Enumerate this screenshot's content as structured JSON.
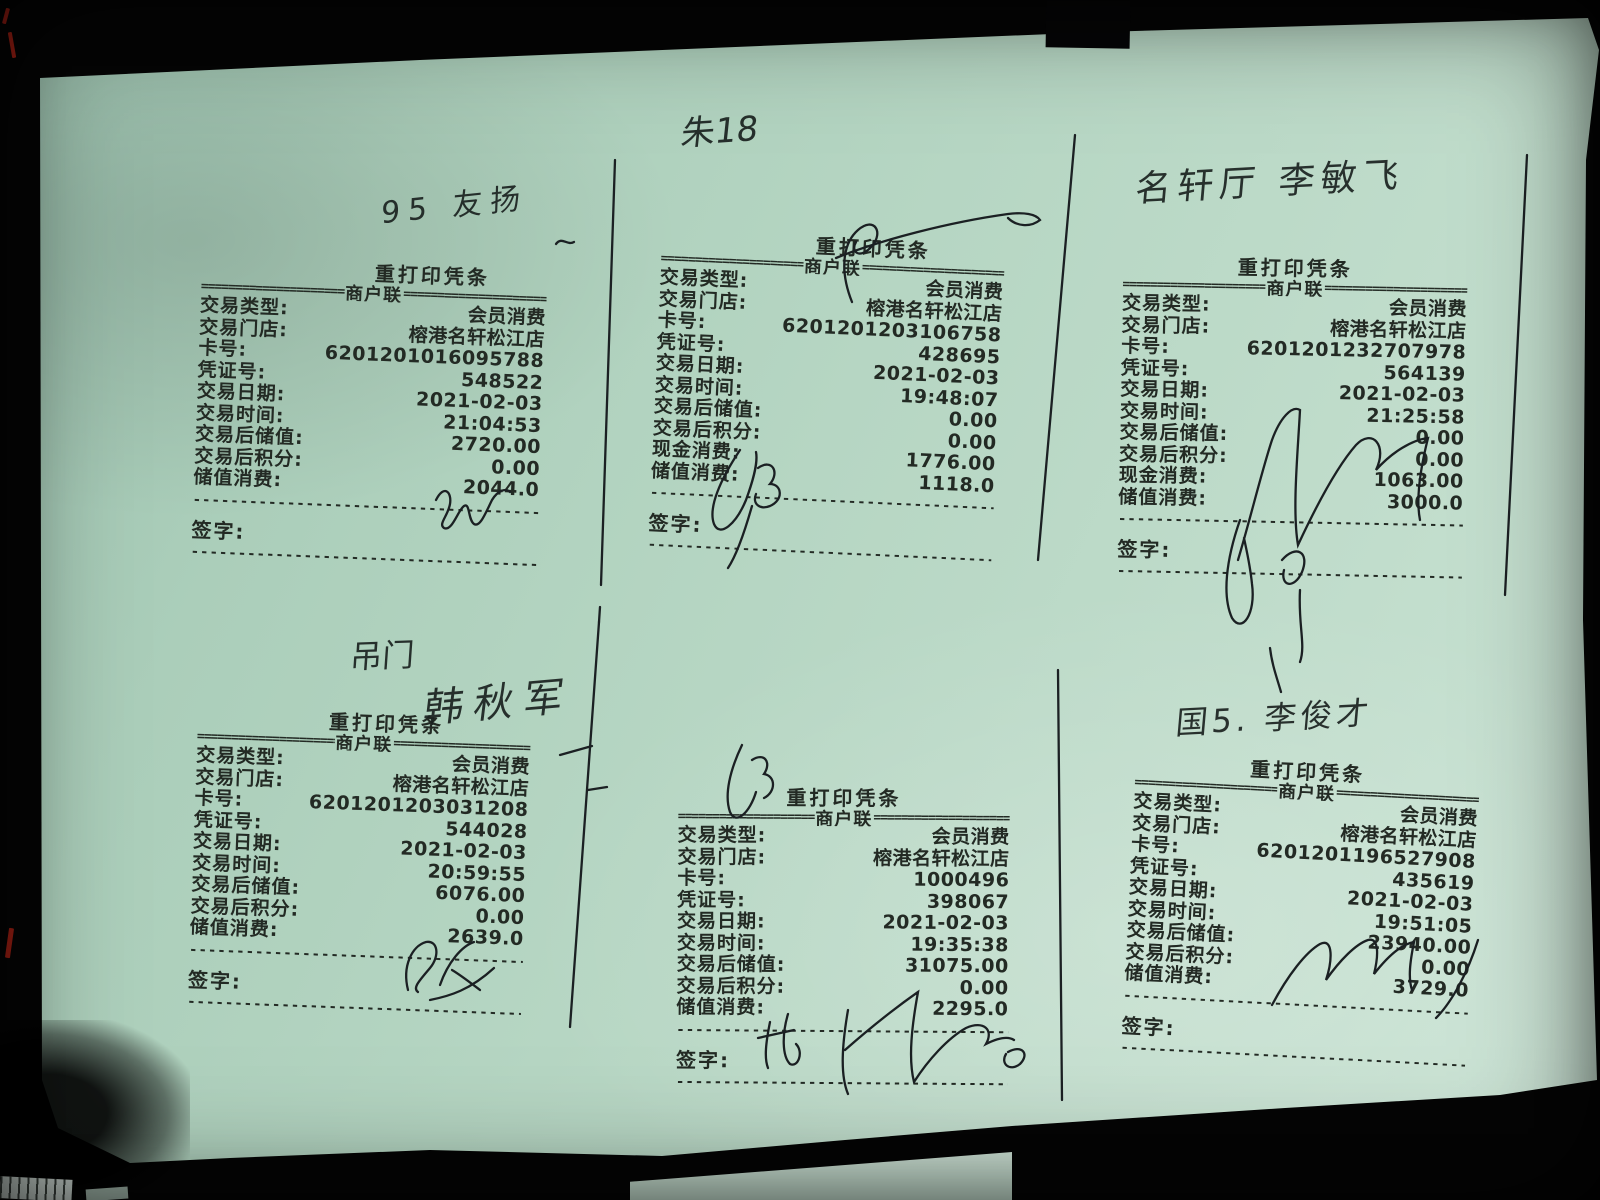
{
  "photo": {
    "paper_color": "#b6d6c3",
    "background_color": "#050505",
    "ink_color": "#232a24",
    "pen_color": "#1b2023",
    "red_mark_color": "#a32014"
  },
  "rules": {
    "eq": "==========================================",
    "dash": "----------------------------------------------------------------"
  },
  "annotations": {
    "top_left": "95 友扬",
    "top_middle": "朱18",
    "top_right": "名轩厅 李敏飞",
    "bottom_left_top": "吊门",
    "bottom_left_name": "韩秋军",
    "bottom_right": "国5. 李俊才"
  },
  "receipts": [
    {
      "position": "top-left",
      "title": "重打印凭条",
      "copy_label": "商户联",
      "sign_label": "签字:",
      "rows": [
        {
          "label": "交易类型:",
          "value": "会员消费"
        },
        {
          "label": "交易门店:",
          "value": "榕港名轩松江店"
        },
        {
          "label": "卡号:",
          "value": "6201201016095788"
        },
        {
          "label": "凭证号:",
          "value": "548522"
        },
        {
          "label": "交易日期:",
          "value": "2021-02-03"
        },
        {
          "label": "交易时间:",
          "value": "21:04:53"
        },
        {
          "label": "交易后储值:",
          "value": "2720.00"
        },
        {
          "label": "交易后积分:",
          "value": "0.00"
        },
        {
          "label": "储值消费:",
          "value": "2044.0"
        }
      ]
    },
    {
      "position": "top-middle",
      "title": "重打印凭条",
      "copy_label": "商户联",
      "sign_label": "签字:",
      "rows": [
        {
          "label": "交易类型:",
          "value": "会员消费"
        },
        {
          "label": "交易门店:",
          "value": "榕港名轩松江店"
        },
        {
          "label": "卡号:",
          "value": "6201201203106758"
        },
        {
          "label": "凭证号:",
          "value": "428695"
        },
        {
          "label": "交易日期:",
          "value": "2021-02-03"
        },
        {
          "label": "交易时间:",
          "value": "19:48:07"
        },
        {
          "label": "交易后储值:",
          "value": "0.00"
        },
        {
          "label": "交易后积分:",
          "value": "0.00"
        },
        {
          "label": "现金消费:",
          "value": "1776.00"
        },
        {
          "label": "储值消费:",
          "value": "1118.0"
        }
      ]
    },
    {
      "position": "top-right",
      "title": "重打印凭条",
      "copy_label": "商户联",
      "sign_label": "签字:",
      "rows": [
        {
          "label": "交易类型:",
          "value": "会员消费"
        },
        {
          "label": "交易门店:",
          "value": "榕港名轩松江店"
        },
        {
          "label": "卡号:",
          "value": "6201201232707978"
        },
        {
          "label": "凭证号:",
          "value": "564139"
        },
        {
          "label": "交易日期:",
          "value": "2021-02-03"
        },
        {
          "label": "交易时间:",
          "value": "21:25:58"
        },
        {
          "label": "交易后储值:",
          "value": "0.00"
        },
        {
          "label": "交易后积分:",
          "value": "0.00"
        },
        {
          "label": "现金消费:",
          "value": "1063.00"
        },
        {
          "label": "储值消费:",
          "value": "3000.0"
        }
      ]
    },
    {
      "position": "bottom-left",
      "title": "重打印凭条",
      "copy_label": "商户联",
      "sign_label": "签字:",
      "rows": [
        {
          "label": "交易类型:",
          "value": "会员消费"
        },
        {
          "label": "交易门店:",
          "value": "榕港名轩松江店"
        },
        {
          "label": "卡号:",
          "value": "6201201203031208"
        },
        {
          "label": "凭证号:",
          "value": "544028"
        },
        {
          "label": "交易日期:",
          "value": "2021-02-03"
        },
        {
          "label": "交易时间:",
          "value": "20:59:55"
        },
        {
          "label": "交易后储值:",
          "value": "6076.00"
        },
        {
          "label": "交易后积分:",
          "value": "0.00"
        },
        {
          "label": "储值消费:",
          "value": "2639.0"
        }
      ]
    },
    {
      "position": "bottom-middle",
      "title": "重打印凭条",
      "copy_label": "商户联",
      "sign_label": "签字:",
      "rows": [
        {
          "label": "交易类型:",
          "value": "会员消费"
        },
        {
          "label": "交易门店:",
          "value": "榕港名轩松江店"
        },
        {
          "label": "卡号:",
          "value": "1000496"
        },
        {
          "label": "凭证号:",
          "value": "398067"
        },
        {
          "label": "交易日期:",
          "value": "2021-02-03"
        },
        {
          "label": "交易时间:",
          "value": "19:35:38"
        },
        {
          "label": "交易后储值:",
          "value": "31075.00"
        },
        {
          "label": "交易后积分:",
          "value": "0.00"
        },
        {
          "label": "储值消费:",
          "value": "2295.0"
        }
      ]
    },
    {
      "position": "bottom-right",
      "title": "重打印凭条",
      "copy_label": "商户联",
      "sign_label": "签字:",
      "rows": [
        {
          "label": "交易类型:",
          "value": "会员消费"
        },
        {
          "label": "交易门店:",
          "value": "榕港名轩松江店"
        },
        {
          "label": "卡号:",
          "value": "6201201196527908"
        },
        {
          "label": "凭证号:",
          "value": "435619"
        },
        {
          "label": "交易日期:",
          "value": "2021-02-03"
        },
        {
          "label": "交易时间:",
          "value": "19:51:05"
        },
        {
          "label": "交易后储值:",
          "value": "23940.00"
        },
        {
          "label": "交易后积分:",
          "value": "0.00"
        },
        {
          "label": "储值消费:",
          "value": "3729.0"
        }
      ]
    }
  ]
}
